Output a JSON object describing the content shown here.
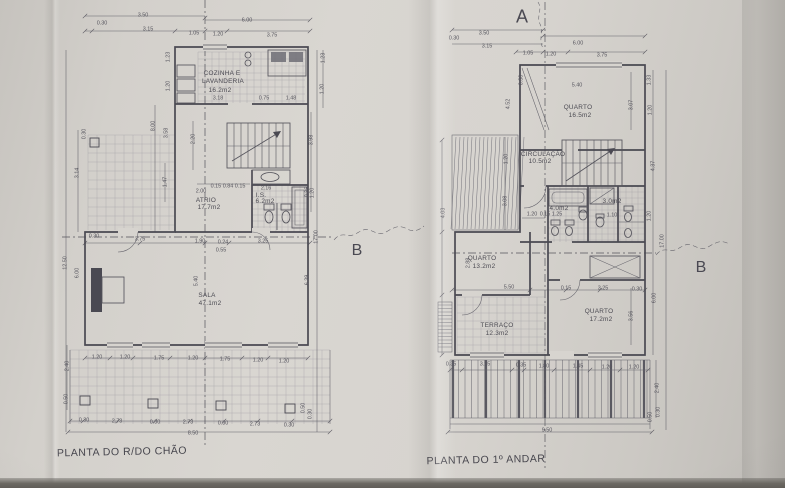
{
  "photo": {
    "paper_color": "#d6d3ce",
    "line_color": "#4a4952",
    "text_color": "#4b4a52"
  },
  "left_plan": {
    "title": "PLANTA DO R/DO CHÃO",
    "section_marker_b": "B",
    "rooms": {
      "cozinha": {
        "name_line1": "COZINHA E",
        "name_line2": "LAVANDERIA",
        "area": "16.2m2"
      },
      "atrio": {
        "name": "ATRIO",
        "area": "17.7m2"
      },
      "is": {
        "name": "I.S.",
        "area": "6.2m2"
      },
      "sala": {
        "name": "SALA",
        "area": "47.1m2"
      }
    },
    "dims": [
      "3.50",
      "0.30",
      "3.15",
      "6.00",
      "1.05",
      "1.20",
      "3.75",
      "1.23",
      "1.20",
      "1.23",
      "1.20",
      "3.18",
      "0.75",
      "1.48",
      "8.00",
      "3.58",
      "0.30",
      "3.14",
      "2.20",
      "3.98",
      "1.47",
      "2.00",
      "0.15 0.84 0.15",
      "2.16",
      "0.35",
      "1.90",
      "0.24",
      "3.25",
      "0.55",
      "0.30",
      "3.75",
      "12.50",
      "6.00",
      "5.40",
      "6.39",
      "1.20",
      "17.00",
      "1.20",
      "1.20",
      "1.75",
      "1.20",
      "1.75",
      "1.20",
      "1.20",
      "2.40",
      "0.50",
      "0.30",
      "2.73",
      "0.30",
      "2.73",
      "0.30",
      "2.73",
      "0.30",
      "8.50",
      "0.50",
      "0.30"
    ]
  },
  "right_plan": {
    "title": "PLANTA DO 1º ANDAR",
    "section_marker_a": "A",
    "section_marker_b": "B",
    "rooms": {
      "quarto_norte": {
        "name": "QUARTO",
        "area": "16.5m2"
      },
      "circulacao": {
        "name": "CIRCULAÇÃO",
        "area": "10.5m2"
      },
      "is_1": {
        "area": "4.0m2"
      },
      "is_2": {
        "area": "3.0m2"
      },
      "quarto_oeste": {
        "name": "QUARTO",
        "area": "13.2m2"
      },
      "terraco": {
        "name": "TERRAÇO",
        "area": "12.3m2"
      },
      "quarto_sul": {
        "name": "QUARTO",
        "area": "17.2m2"
      }
    },
    "dims": [
      "3.50",
      "0.30",
      "3.15",
      "6.00",
      "1.05",
      "1.20",
      "3.75",
      "5.40",
      "0.30",
      "1.33",
      "1.20",
      "3.07",
      "4.52",
      "4.03",
      "1.20",
      "3.08",
      "4.37",
      "1.20",
      "0.15",
      "1.25",
      "1.10",
      "1.20",
      "17.00",
      "2.88",
      "5.50",
      "0.15",
      "3.25",
      "0.30",
      "6.00",
      "3.56",
      "0.35",
      "3.15",
      "0.35",
      "1.80",
      "1.45",
      "1.20",
      "1.20",
      "2.40",
      "0.50",
      "0.30",
      "9.50"
    ]
  }
}
